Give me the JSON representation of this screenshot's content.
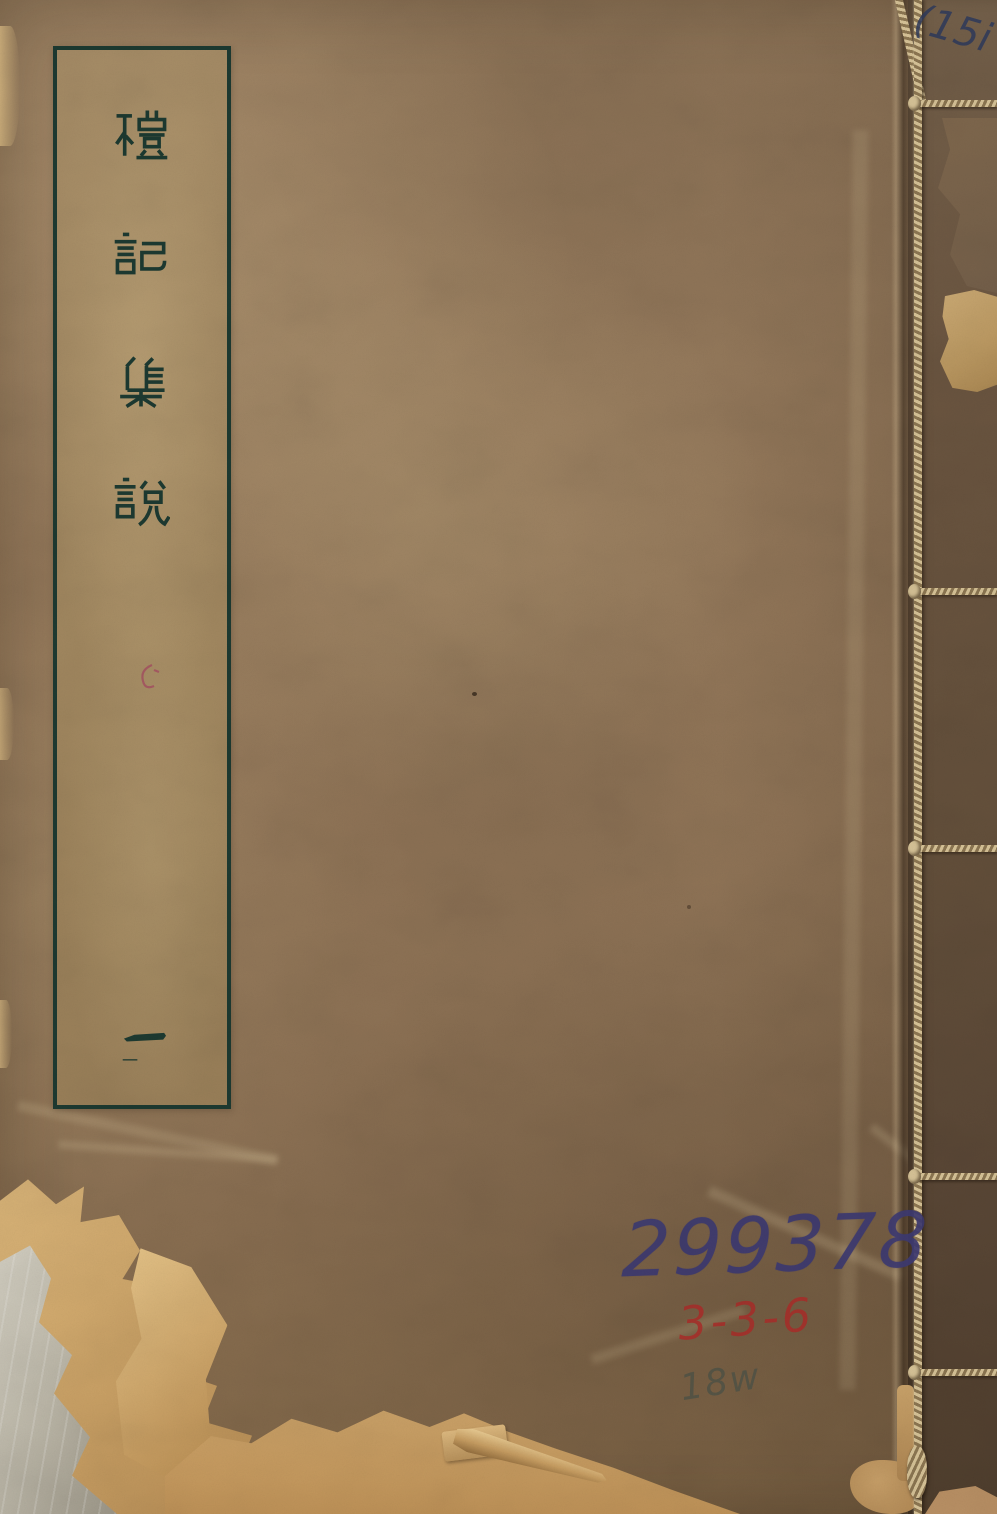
{
  "title_label": {
    "text_vertical": "禮記集說",
    "chars": [
      "禮",
      "記",
      "集",
      "說"
    ],
    "volume_char": "一"
  },
  "inscriptions": {
    "blue_number": "299378",
    "red_number": "3-3-6",
    "pencil_scribble": "18w",
    "corner_note": "(15i"
  },
  "colors": {
    "ink": "#1d3a31",
    "blue_ink": "#3d3a72",
    "red_ink": "#ab2f2a",
    "scribble_ink": "#4f5347",
    "pencil_ink": "#2e3a5c",
    "cord": "#d8c498",
    "cord_dark": "#8d7752",
    "cover": "#93775a",
    "label_bg": "#a1875f",
    "strip": "#64503b",
    "tear_paper": "#dcb77b",
    "tear_under": "#c6c2b5"
  }
}
